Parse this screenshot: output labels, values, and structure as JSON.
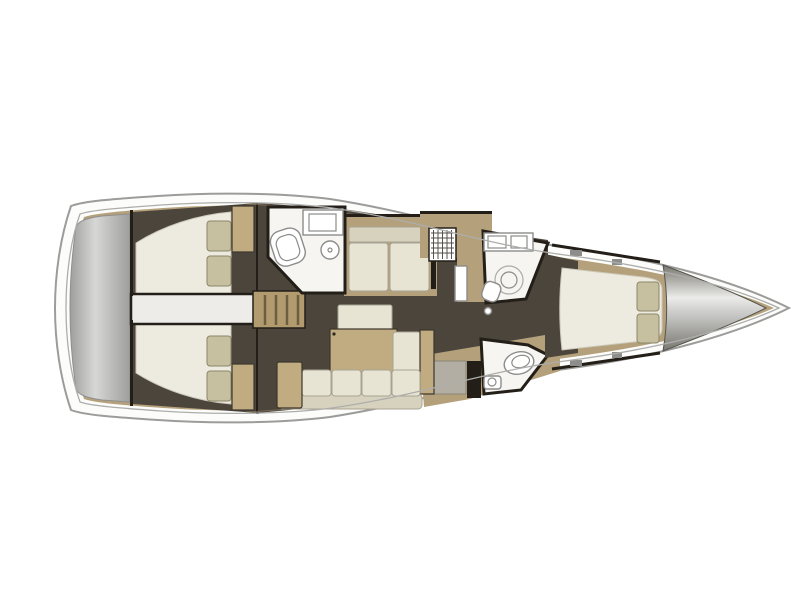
{
  "image": {
    "kind": "yacht-interior-floor-plan",
    "orientation": "bow-right",
    "width_px": 800,
    "height_px": 600
  },
  "counts": {
    "cabins": 3,
    "heads": 3,
    "double_berths": 3,
    "pillows": 6
  },
  "rooms": [
    {
      "name": "stern-swim-platform",
      "fixtures": []
    },
    {
      "name": "aft-cabin-port",
      "fixtures": [
        "double-berth",
        "pillow",
        "pillow",
        "wardrobe"
      ]
    },
    {
      "name": "aft-cabin-starboard",
      "fixtures": [
        "double-berth",
        "pillow",
        "pillow",
        "wardrobe"
      ]
    },
    {
      "name": "aft-corridor",
      "fixtures": []
    },
    {
      "name": "companionway",
      "fixtures": [
        "steps"
      ]
    },
    {
      "name": "aft-head",
      "fixtures": [
        "counter-sink",
        "toilet",
        "round-sink"
      ]
    },
    {
      "name": "salon",
      "fixtures": [
        "settee",
        "bench-seat",
        "table",
        "chaise",
        "l-sofa"
      ]
    },
    {
      "name": "galley",
      "fixtures": [
        "stove-grid",
        "counter"
      ]
    },
    {
      "name": "forward-head-shower",
      "fixtures": [
        "vanity-sinks",
        "shower",
        "toilet"
      ]
    },
    {
      "name": "forward-head",
      "fixtures": [
        "toilet",
        "sink"
      ]
    },
    {
      "name": "forward-cabin",
      "fixtures": [
        "double-berth",
        "pillow",
        "pillow"
      ]
    },
    {
      "name": "bow-locker",
      "fixtures": []
    }
  ],
  "colors": {
    "hull_fill": "#fcfcfa",
    "hull_stroke": "#9c9c9a",
    "deck_line": "#adadab",
    "wood_tan": "#b4a17b",
    "wood_seam": "#9c8a64",
    "wood_dark": "#3c362b",
    "floor_dark": "#4b453c",
    "wall_dark": "#231f18",
    "room_white": "#f6f5f1",
    "corridor_white": "#edece8",
    "bed_cream": "#edeadf",
    "bed_edge": "#ccc8b9",
    "pillow_khaki": "#c6c0a0",
    "pillow_stroke": "#8b8668",
    "cushion_cream": "#e8e4d4",
    "cushion_shade": "#d7d2be",
    "cushion_edge": "#a8a394",
    "table_tan": "#c1ac82",
    "steps_tan": "#b29c6f",
    "steps_line": "#6d5e41",
    "fixture_white": "#ffffff",
    "fixture_stroke": "#8c8c8a",
    "grid_line": "#55504a",
    "transom_light": "#d7d7d5",
    "transom_dark": "#9e9e9c",
    "transom_edge": "#8f8f8d",
    "bow_light": "#ebebe9",
    "bow_mid": "#c0c0be",
    "bow_dark": "#78776f",
    "bow_edge": "#56544c",
    "hardware_gray": "#8d8d8b",
    "gray_block": "#b3aea3",
    "gray_block_edge": "#8a857a"
  }
}
